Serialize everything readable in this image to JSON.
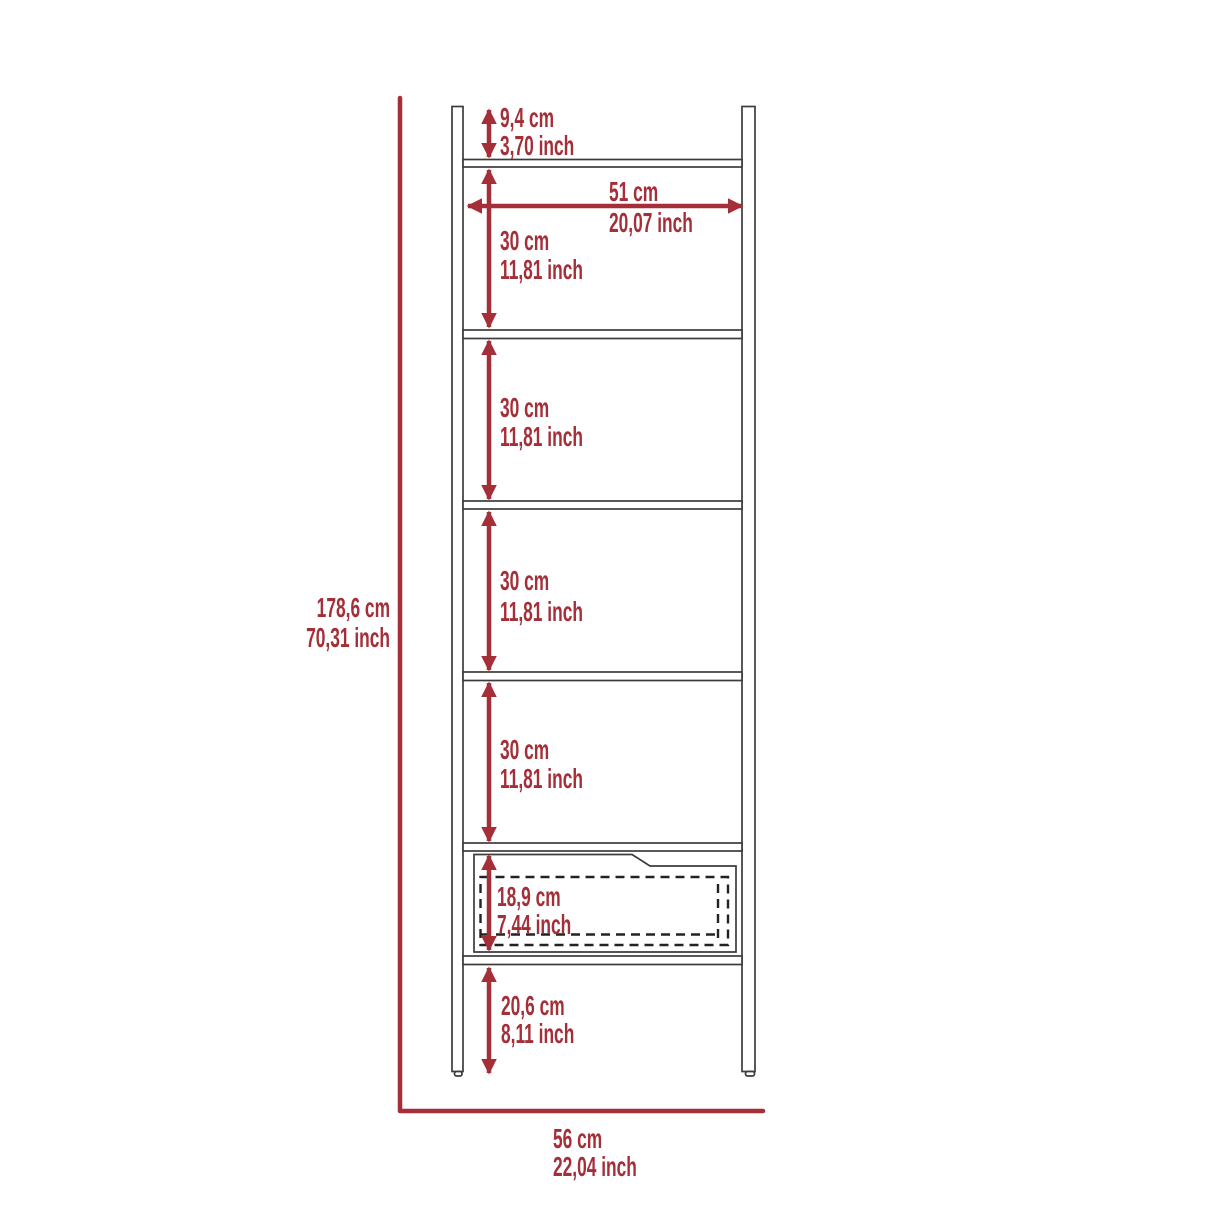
{
  "colors": {
    "background": "#FFFFFF",
    "accent": "#A42F38",
    "outline": "#3C3C3C"
  },
  "dims": {
    "total": {
      "cm": "178,6 cm",
      "inch": "70,31 inch"
    },
    "top": {
      "cm": "9,4 cm",
      "inch": "3,70 inch"
    },
    "width": {
      "cm": "51 cm",
      "inch": "20,07 inch"
    },
    "shelf1": {
      "cm": "30 cm",
      "inch": "11,81 inch"
    },
    "shelf2": {
      "cm": "30 cm",
      "inch": "11,81 inch"
    },
    "shelf3": {
      "cm": "30 cm",
      "inch": "11,81 inch"
    },
    "shelf4": {
      "cm": "30 cm",
      "inch": "11,81 inch"
    },
    "drawer": {
      "cm": "18,9 cm",
      "inch": "7,44 inch"
    },
    "bottom": {
      "cm": "20,6 cm",
      "inch": "8,11 inch"
    },
    "base": {
      "cm": "56 cm",
      "inch": "22,04 inch"
    }
  }
}
